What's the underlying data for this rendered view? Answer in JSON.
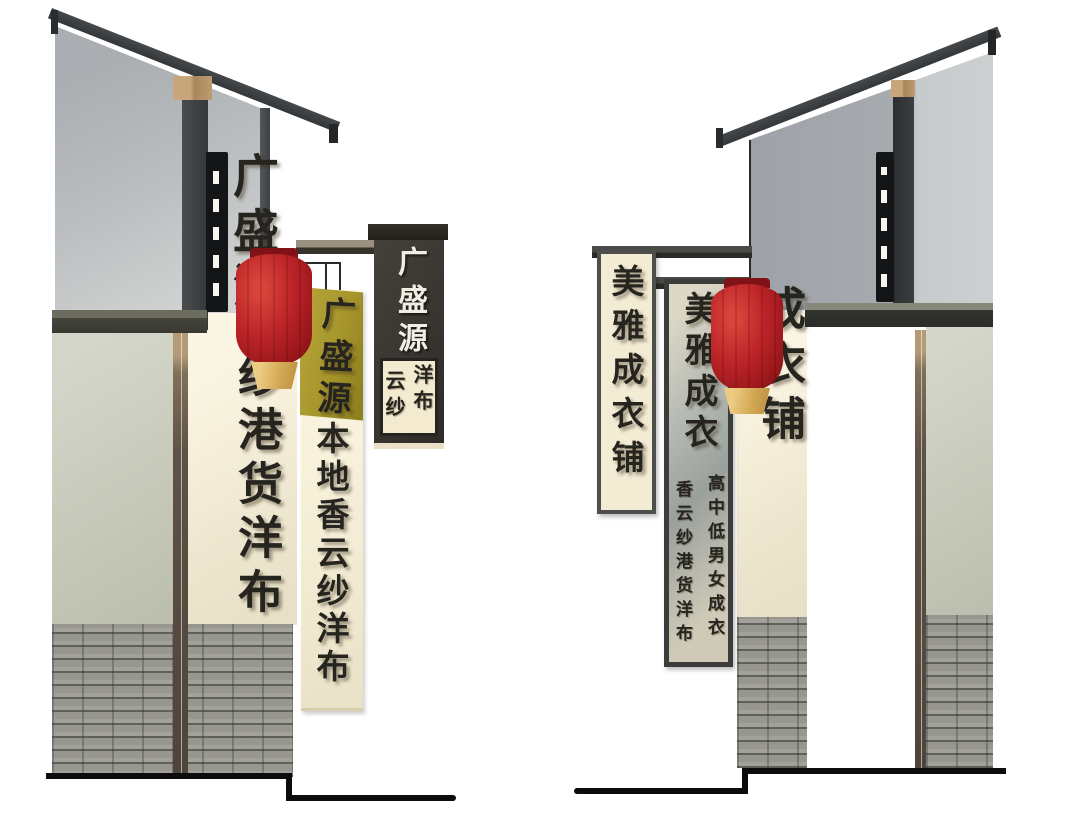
{
  "left_building": {
    "gable_text": "广盛源",
    "lower_wall_text": "纱港货洋布",
    "banner": {
      "header": "广盛源",
      "body": "本地香云纱洋布"
    },
    "board_sign": {
      "title": "广盛源",
      "col_right": "洋布",
      "col_left": "云纱"
    }
  },
  "right_building": {
    "wall_text": "成衣铺",
    "framed_banner_text": "美雅成衣铺",
    "inner_banner": {
      "title": "美雅成衣",
      "col_right": "高中低男女成衣",
      "col_left": "香云纱港货洋布"
    }
  },
  "colors": {
    "background": "#ffffff",
    "roof": "#3d4043",
    "gable_gray": "#b5b8bb",
    "plaster_green": "#c6c9ba",
    "plaster_cream": "#f1ead4",
    "brick": "#98978f",
    "wood_post": "#5f5246",
    "lantern_red": "#bc2428",
    "lantern_gold": "#d3a955",
    "banner_olive": "#a6952c",
    "banner_cream": "#f4edd5",
    "sign_dark": "#38342f",
    "ink": "#26241f",
    "ground_line": "#0c0c0c"
  }
}
